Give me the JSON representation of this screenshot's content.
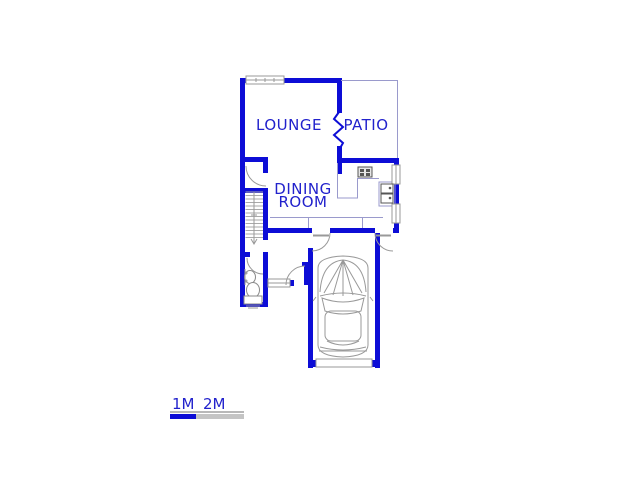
{
  "plan": {
    "type": "floor-plan",
    "rooms": {
      "lounge": "LOUNGE",
      "patio": "PATIO",
      "dining_line1": "DINING",
      "dining_line2": "ROOM"
    },
    "fixtures": [
      "staircase-icon",
      "toilet-icon",
      "basin-icon",
      "stove-icon",
      "kitchen-sink-icon",
      "car-icon",
      "garage-door-icon",
      "window-icon",
      "door-swing-icon",
      "wall-break-icon"
    ]
  },
  "scale_bar": {
    "label_1m": "1M",
    "label_2m": "2M"
  },
  "colors": {
    "wall_blue": "#0d0dd6",
    "label_blue": "#2222cc",
    "thin_lavender": "#9a9acc",
    "fixture_gray": "#999999",
    "scale_gray": "#c4c4c4",
    "background": "#ffffff"
  }
}
